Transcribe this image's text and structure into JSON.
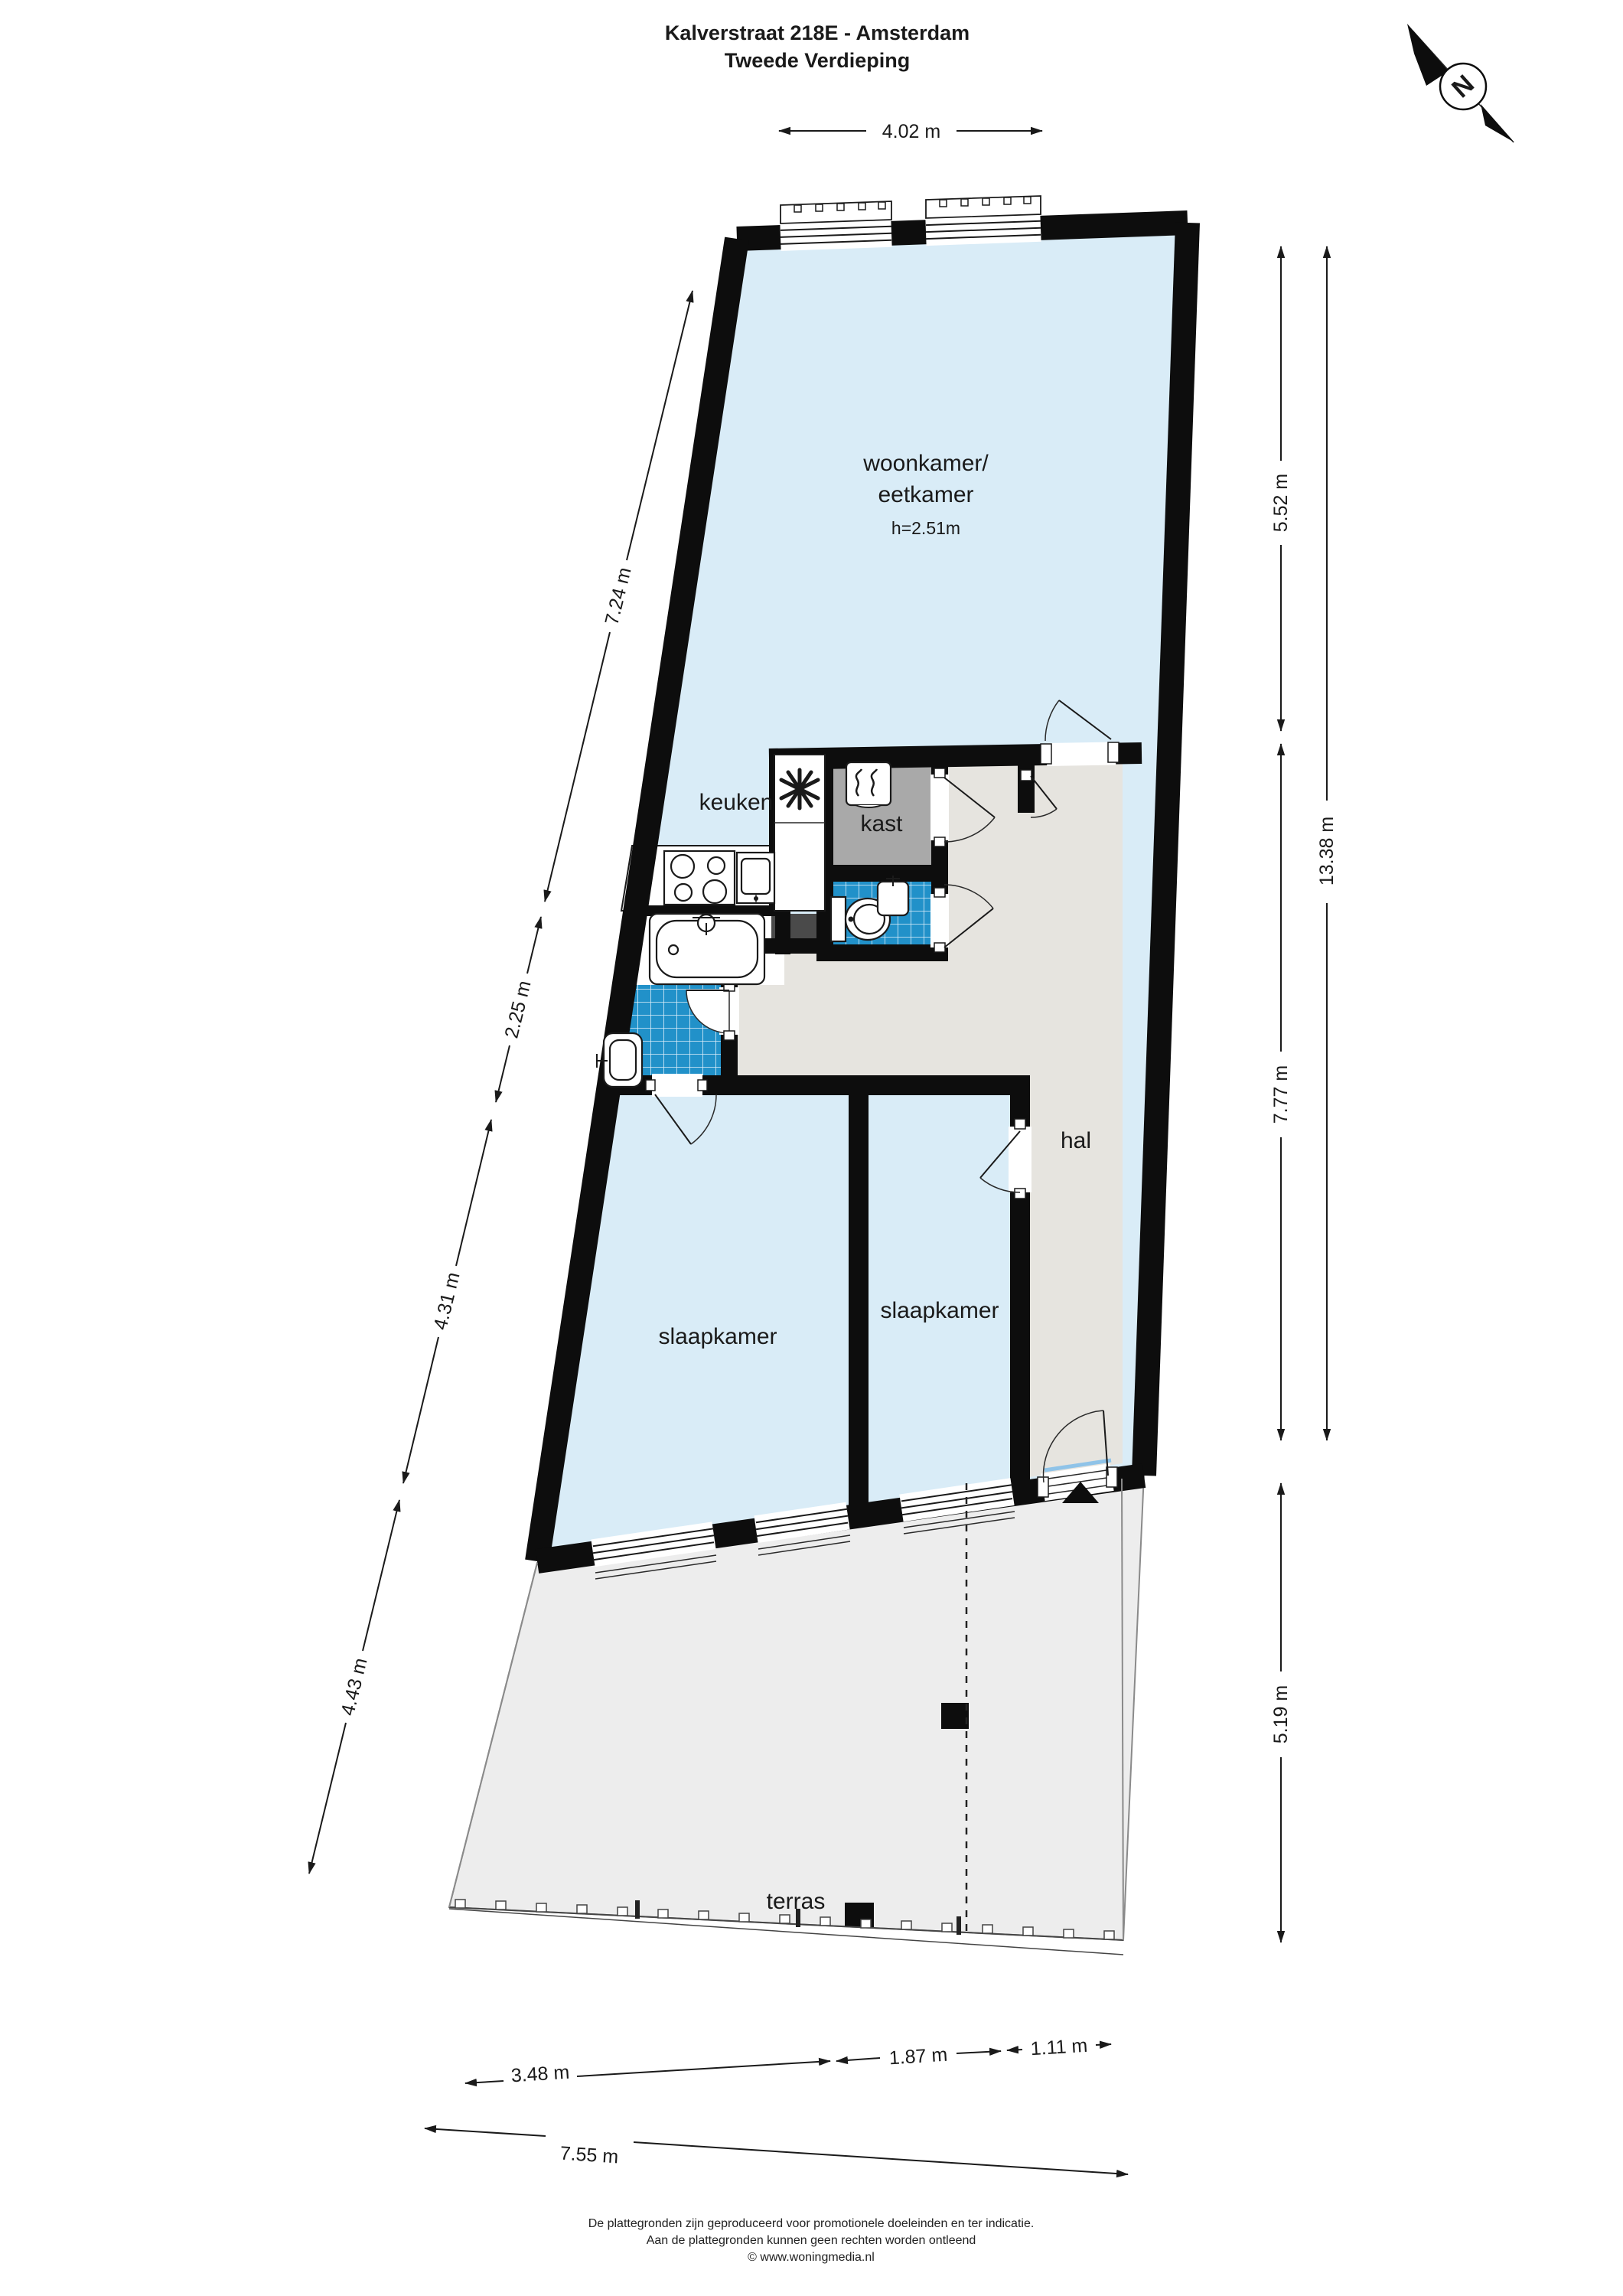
{
  "title": {
    "line1": "Kalverstraat 218E - Amsterdam",
    "line2": "Tweede Verdieping"
  },
  "compass": {
    "label": "N"
  },
  "rooms": {
    "woonkamer": {
      "label_line1": "woonkamer/",
      "label_line2": "eetkamer",
      "height_note": "h=2.51m"
    },
    "keuken": {
      "label": "keuken"
    },
    "kast": {
      "label": "kast"
    },
    "hal": {
      "label": "hal"
    },
    "slaapkamer_links": {
      "label": "slaapkamer"
    },
    "slaapkamer_rechts": {
      "label": "slaapkamer"
    },
    "terras": {
      "label": "terras"
    }
  },
  "dimensions": {
    "top": "4.02 m",
    "left": [
      "7.24 m",
      "2.25 m",
      "4.31 m",
      "4.43 m"
    ],
    "right": [
      "5.52 m",
      "13.38 m",
      "7.77 m",
      "5.19 m"
    ],
    "bottom": [
      "3.48 m",
      "1.87 m",
      "1.11 m",
      "7.55 m"
    ]
  },
  "footer": {
    "line1": "De plattegronden zijn geproduceerd voor promotionele doeleinden en ter indicatie.",
    "line2": "Aan de plattegronden kunnen geen rechten worden ontleend",
    "line3": "© www.woningmedia.nl"
  },
  "colors": {
    "room_blue": "#d9ecf7",
    "tile_blue": "#2191c9",
    "kast_gray": "#a9a9a9",
    "hal_gray": "#e6e4df",
    "terras_gray": "#ededed",
    "shaft_dark": "#4a4a4a",
    "wall_black": "#0d0d0d"
  }
}
